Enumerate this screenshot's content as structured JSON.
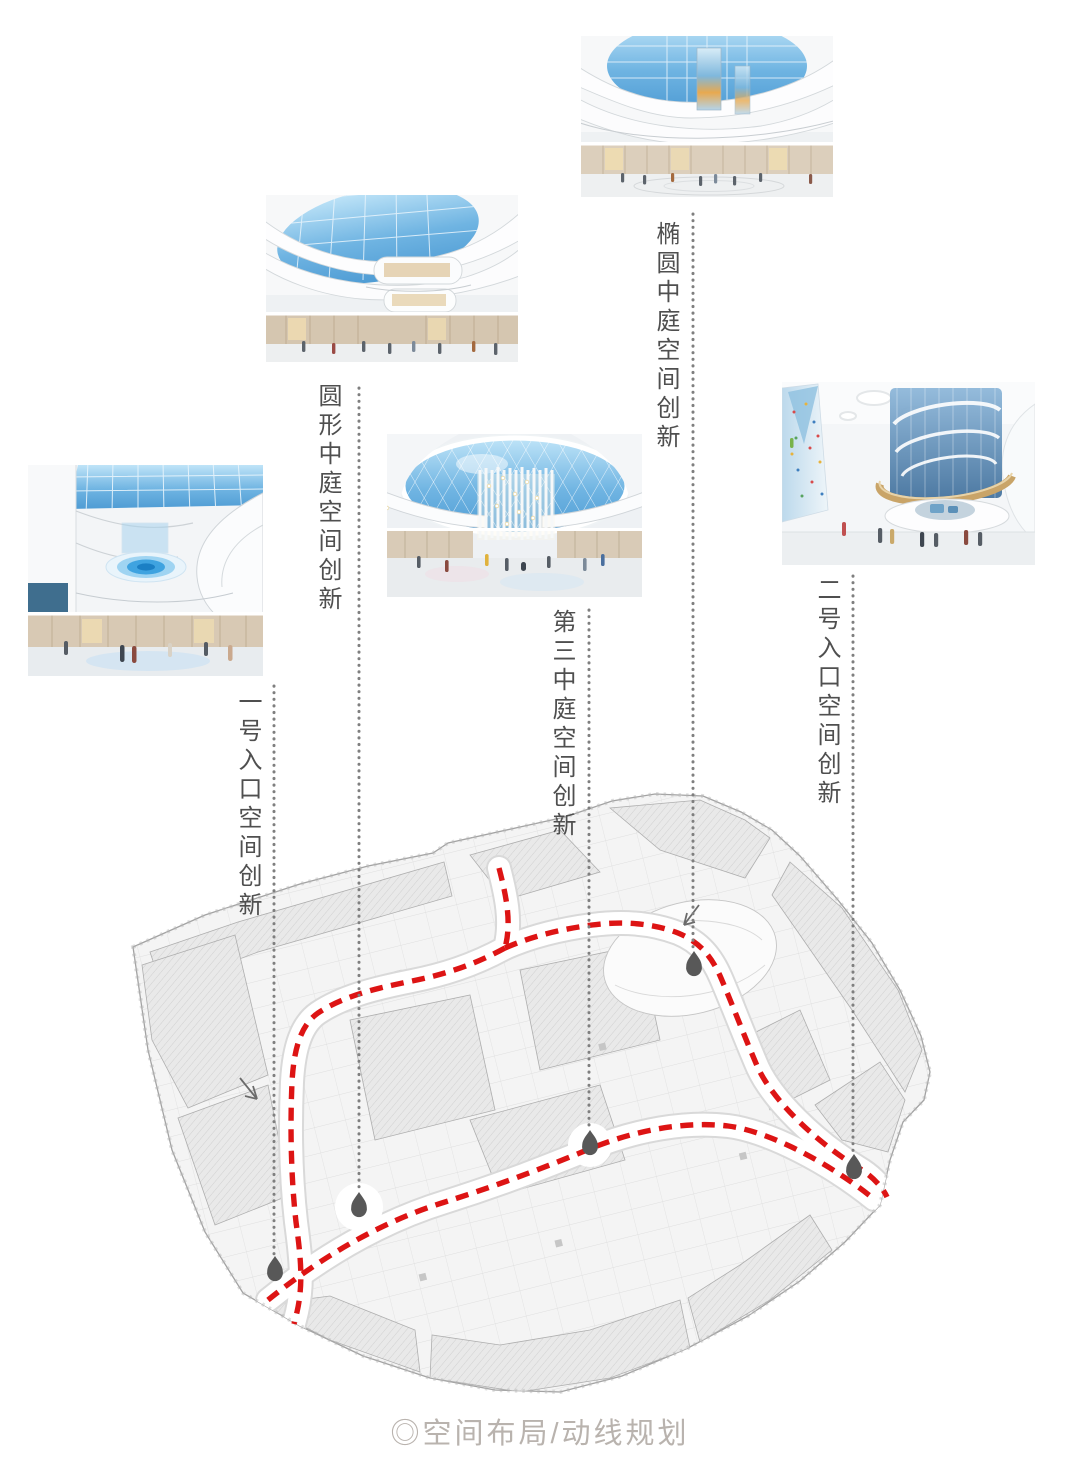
{
  "page": {
    "caption": "◎空间布局/动线规划"
  },
  "colors": {
    "route_red": "#dd1414",
    "leader_dot_gray": "#7f7f7f",
    "marker_gray": "#585858",
    "label_text": "#4f4f4f",
    "caption_gray": "#b9b3ae"
  },
  "annotations": {
    "oval_atrium": {
      "label": "椭圆中庭空间创新",
      "photo_icon": "oval-atrium-rendering"
    },
    "round_atrium": {
      "label": "圆形中庭空间创新",
      "photo_icon": "round-atrium-rendering"
    },
    "entrance_1": {
      "label": "一号入口空间创新",
      "photo_icon": "entrance-1-rendering"
    },
    "third_atrium": {
      "label": "第三中庭空间创新",
      "photo_icon": "third-atrium-rendering"
    },
    "entrance_2": {
      "label": "二号入口空间创新",
      "photo_icon": "entrance-2-rendering"
    }
  },
  "floor_plan": {
    "kind": "mall-level-plan",
    "route_style": "red-dashed-circulation-line",
    "marker_icon": "pin-dot-marker",
    "leader_icon": "vertical-dotted-leader"
  }
}
